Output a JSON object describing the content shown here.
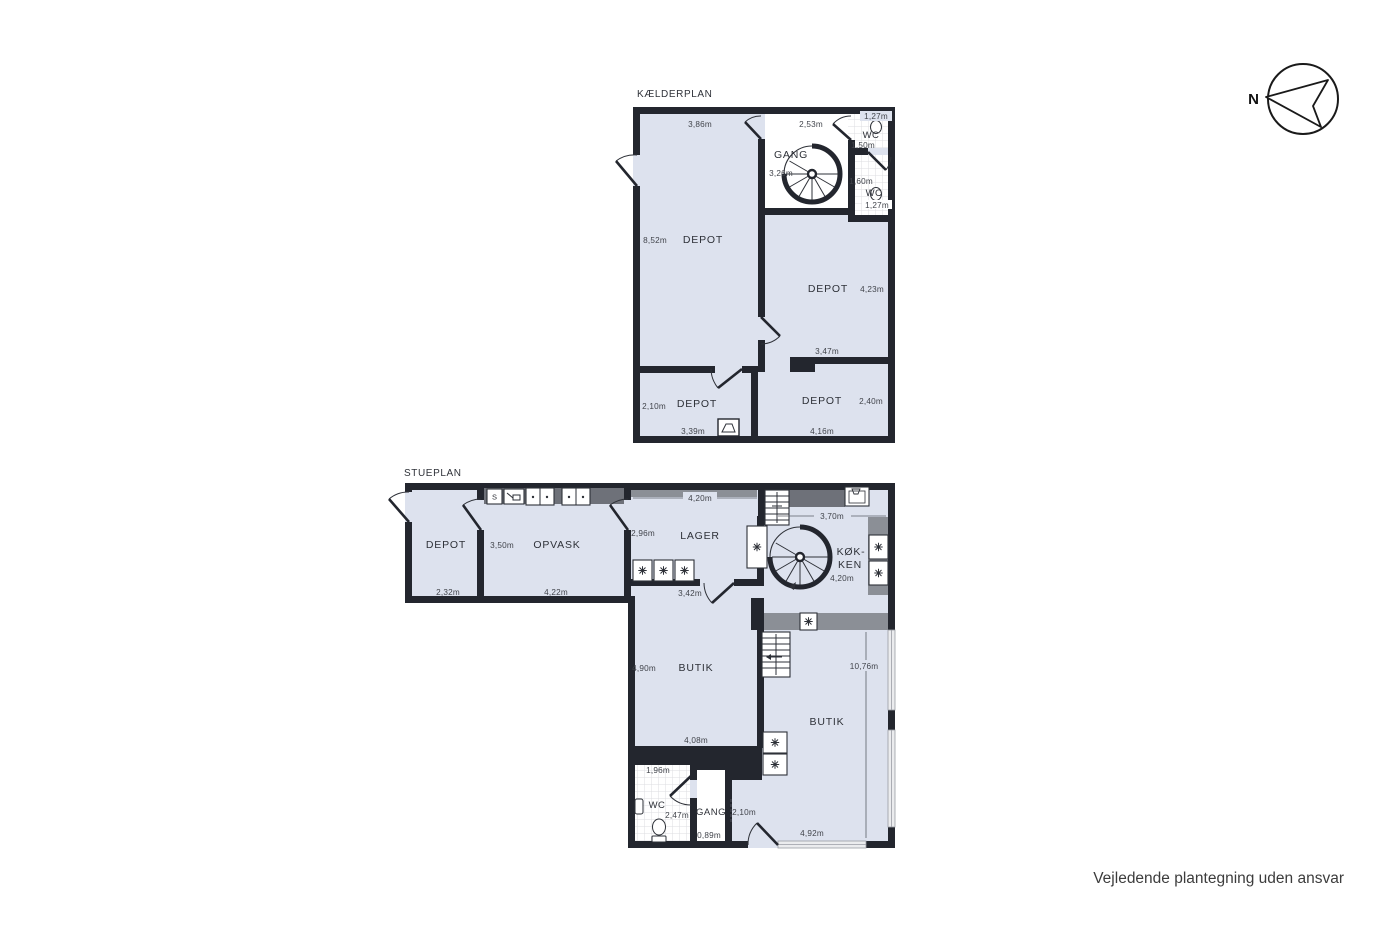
{
  "colors": {
    "wall": "#23262e",
    "floor": "#dde2ee",
    "counter_dark": "#6e7179",
    "counter_light": "#8b8f96"
  },
  "compass": {
    "label": "N"
  },
  "footer": {
    "disclaimer": "Vejledende plantegning uden ansvar"
  },
  "kaelderplan": {
    "title": "KÆLDERPLAN",
    "depot_main": {
      "label": "DEPOT",
      "dim_top": "3,86m",
      "dim_left": "8,52m"
    },
    "gang": {
      "label": "GANG",
      "dim_top": "2,53m",
      "dim_left": "3,26m"
    },
    "wc_top": {
      "label": "WC",
      "dim_top": "1,27m",
      "dim_bottom": "1,50m"
    },
    "wc_bottom": {
      "label": "WC",
      "dim_top": "1,60m",
      "dim_bottom": "1,27m"
    },
    "depot_right": {
      "label": "DEPOT",
      "dim_right": "4,23m",
      "dim_bottom": "3,47m"
    },
    "depot_sw": {
      "label": "DEPOT",
      "dim_left": "2,10m",
      "dim_bottom": "3,39m"
    },
    "depot_se": {
      "label": "DEPOT",
      "dim_right": "2,40m",
      "dim_bottom": "4,16m"
    }
  },
  "stueplan": {
    "title": "STUEPLAN",
    "depot": {
      "label": "DEPOT",
      "dim_bottom": "2,32m"
    },
    "opvask": {
      "label": "OPVASK",
      "dim_left": "3,50m",
      "dim_bottom": "4,22m",
      "cabinet": "S"
    },
    "lager": {
      "label": "LAGER",
      "dim_top": "4,20m",
      "dim_left": "2,96m",
      "dim_bottom": "3,42m"
    },
    "koekken": {
      "label_line1": "KØK-",
      "label_line2": "KEN",
      "dim_top": "3,70m",
      "dim_bottom": "4,20m"
    },
    "butik_left": {
      "label": "BUTIK",
      "dim_left": "4,90m",
      "dim_bottom": "4,08m"
    },
    "butik_right": {
      "label": "BUTIK",
      "dim_right": "10,76m",
      "dim_bottom": "4,92m"
    },
    "wc": {
      "label": "WC",
      "dim_top": "1,96m",
      "dim_right": "2,47m"
    },
    "gang": {
      "label": "GANG",
      "dim_right": "2,10m",
      "dim_bottom": "0,89m"
    }
  }
}
